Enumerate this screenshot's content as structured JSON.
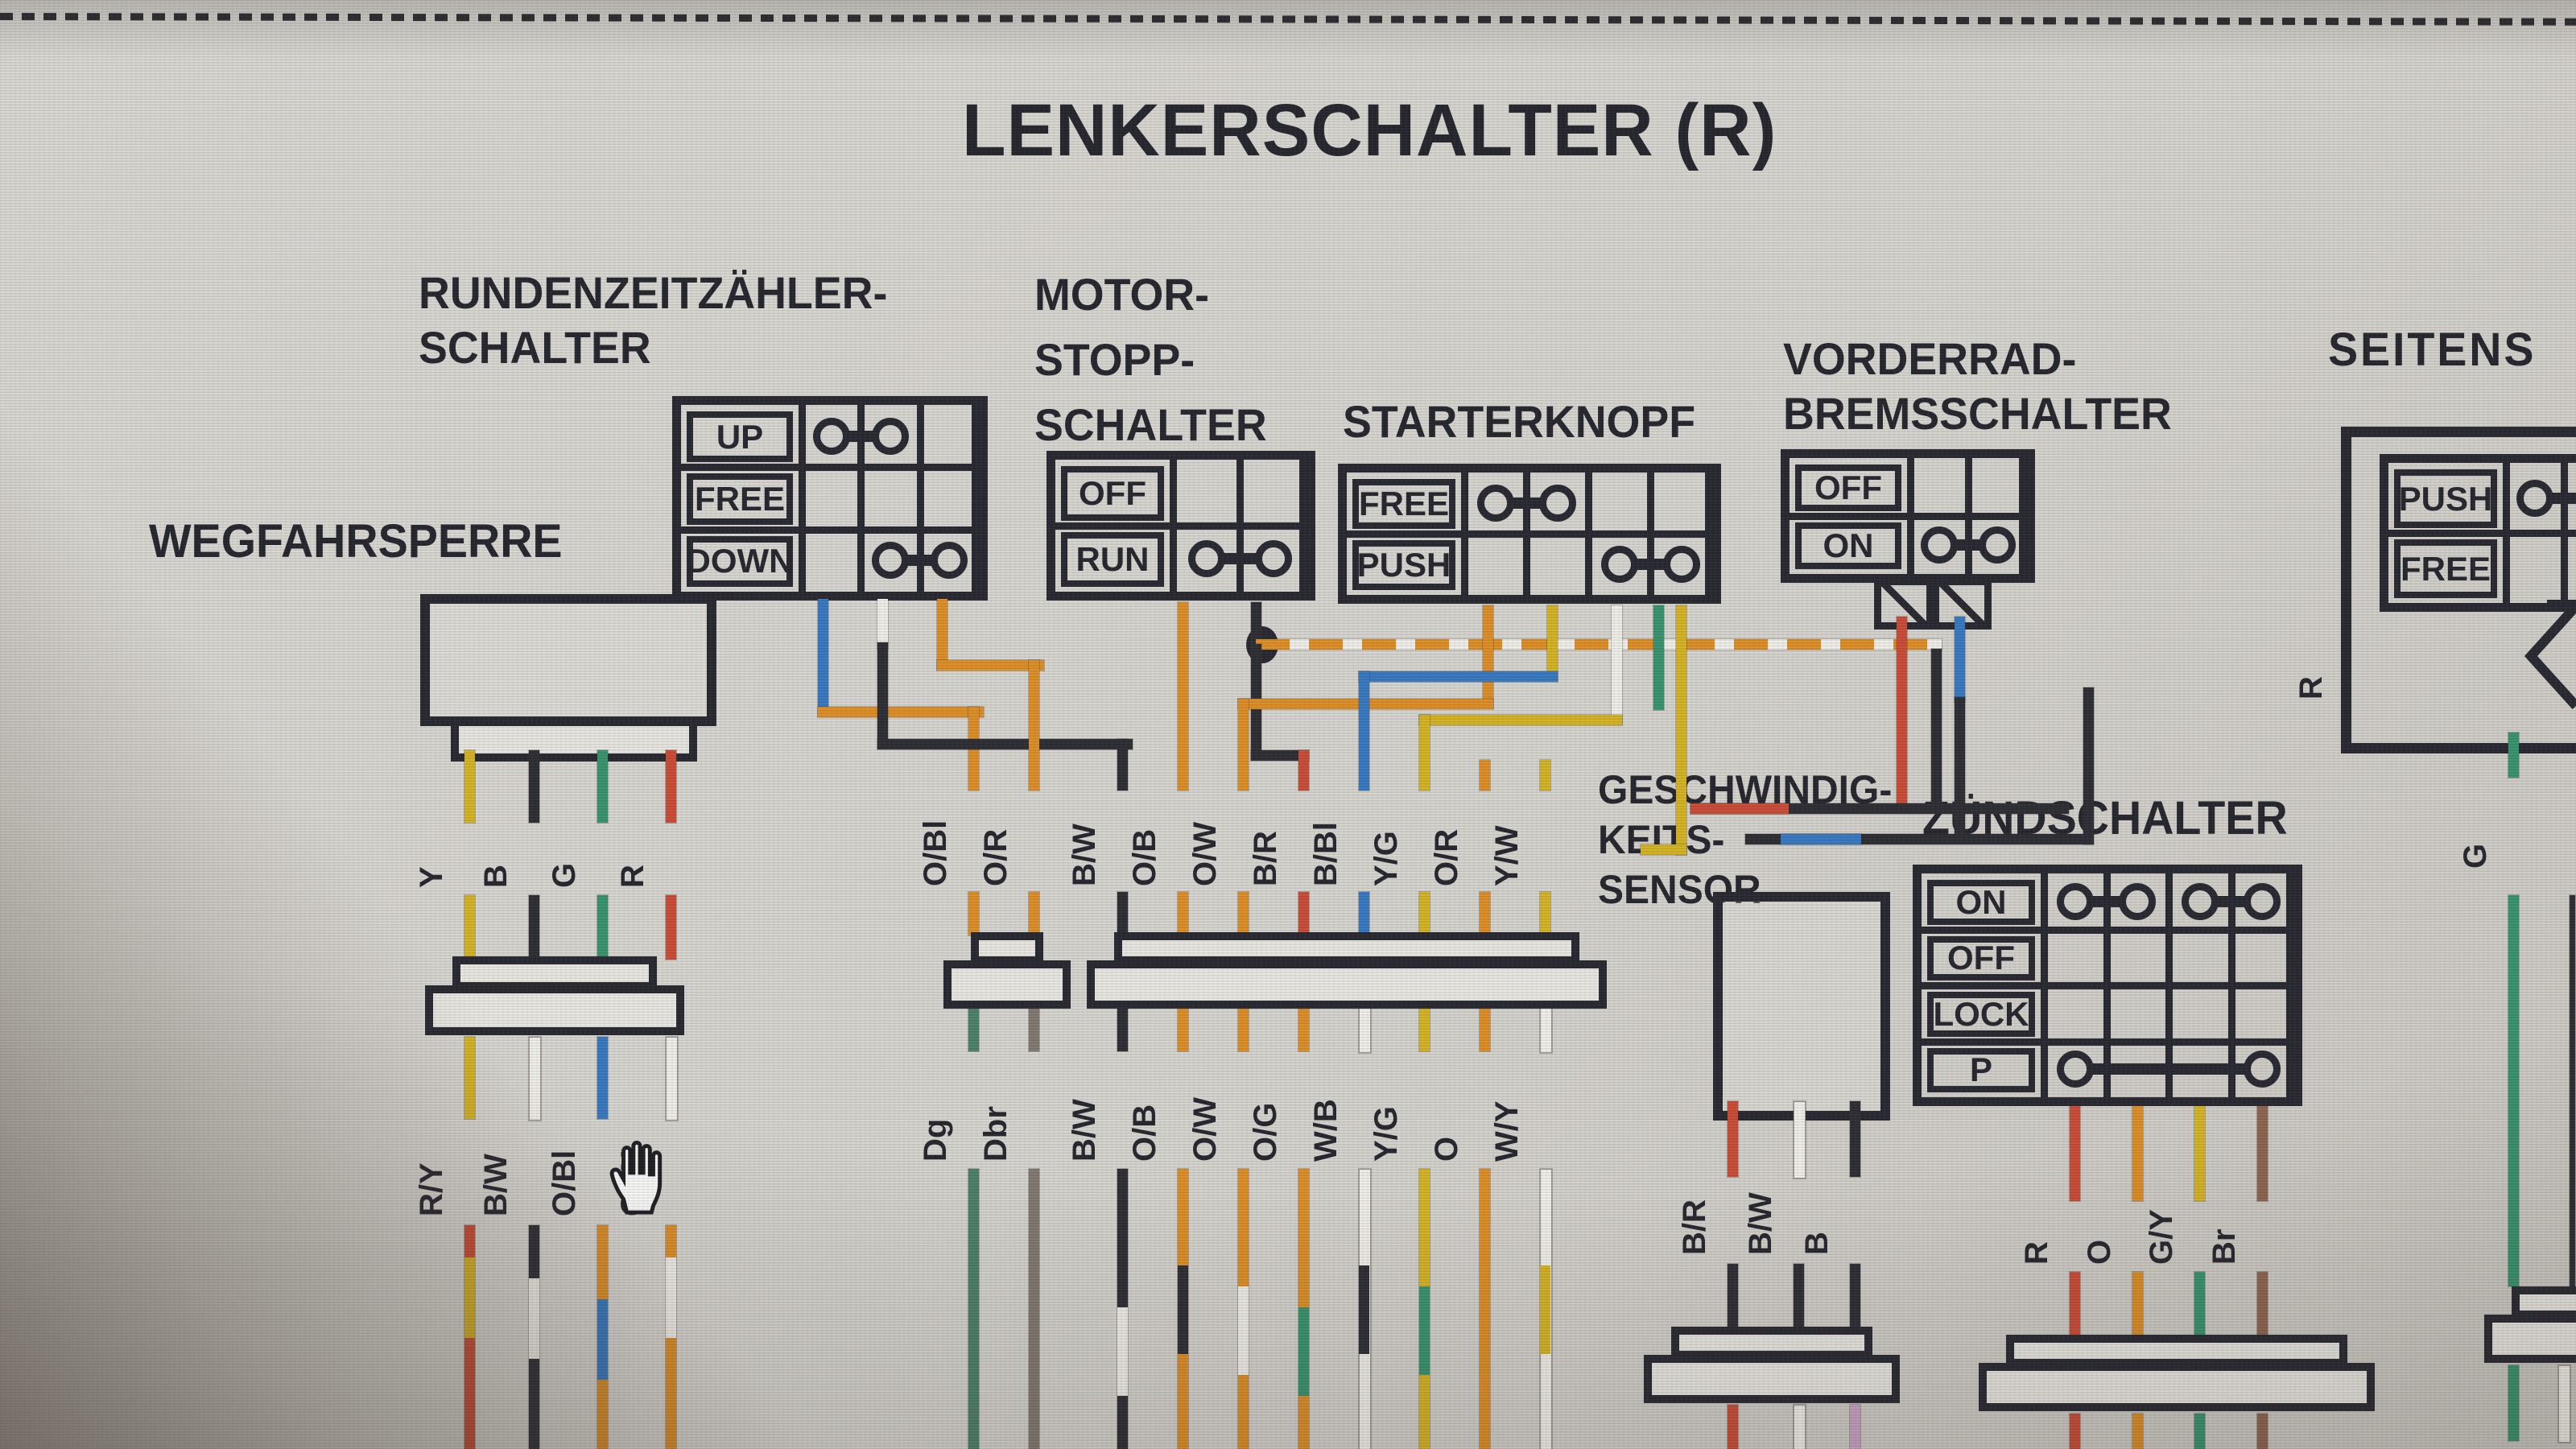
{
  "title": "LENKERSCHALTER (R)",
  "sections": {
    "runden": {
      "line1": "RUNDENZEITZÄHLER-",
      "line2": "SCHALTER"
    },
    "motor": {
      "line1": "MOTOR-",
      "line2": "STOPP-",
      "line3": "SCHALTER"
    },
    "starter": {
      "line1": "STARTERKNOPF"
    },
    "vorder": {
      "line1": "VORDERRAD-",
      "line2": "BREMSSCHALTER"
    },
    "seiten": {
      "line1": "SEITENS"
    },
    "weg": {
      "line1": "WEGFAHRSPERRE"
    },
    "sensor": {
      "line1": "GESCHWINDIG-",
      "line2": "KEITS-",
      "line3": "SENSOR"
    },
    "zuend": {
      "line1": "ZÜNDSCHALTER"
    }
  },
  "switches": {
    "runden": {
      "cols": 3,
      "rows": [
        {
          "label": "UP",
          "bridges": [
            [
              1,
              2
            ]
          ]
        },
        {
          "label": "FREE",
          "bridges": []
        },
        {
          "label": "DOWN",
          "bridges": [
            [
              2,
              3
            ]
          ]
        }
      ]
    },
    "motor": {
      "cols": 2,
      "rows": [
        {
          "label": "OFF",
          "bridges": []
        },
        {
          "label": "RUN",
          "bridges": [
            [
              1,
              2
            ]
          ]
        }
      ]
    },
    "starter": {
      "cols": 4,
      "rows": [
        {
          "label": "FREE",
          "bridges": [
            [
              1,
              2
            ]
          ]
        },
        {
          "label": "PUSH",
          "bridges": [
            [
              3,
              4
            ]
          ]
        }
      ]
    },
    "vorder": {
      "cols": 2,
      "rows": [
        {
          "label": "OFF",
          "bridges": []
        },
        {
          "label": "ON",
          "bridges": [
            [
              1,
              2
            ]
          ]
        }
      ]
    },
    "seiten": {
      "cols": 2,
      "rows": [
        {
          "label": "PUSH",
          "bridges": [
            [
              1,
              2
            ]
          ]
        },
        {
          "label": "FREE",
          "bridges": []
        }
      ]
    },
    "zuend": {
      "cols": 4,
      "rows": [
        {
          "label": "ON",
          "bridges": [
            [
              1,
              2
            ],
            [
              3,
              4
            ]
          ]
        },
        {
          "label": "OFF",
          "bridges": []
        },
        {
          "label": "LOCK",
          "bridges": []
        },
        {
          "label": "P",
          "bridges": [
            [
              1,
              4
            ]
          ]
        }
      ]
    }
  },
  "wires": {
    "weg_top": [
      {
        "label": "Y",
        "base": "yellow"
      },
      {
        "label": "B",
        "base": "black"
      },
      {
        "label": "G",
        "base": "green"
      },
      {
        "label": "R",
        "base": "red"
      }
    ],
    "weg_bottom": [
      {
        "label": "R/Y",
        "base": "red",
        "band": "yellow"
      },
      {
        "label": "B/W",
        "base": "black",
        "band": "white"
      },
      {
        "label": "O/Bl",
        "base": "orange",
        "band": "blue"
      },
      {
        "label": "O/W",
        "base": "orange",
        "band": "white"
      }
    ],
    "mid_top": [
      {
        "label": "O/Bl",
        "base": "orange",
        "band": "blue"
      },
      {
        "label": "O/R",
        "base": "orange",
        "band": "red"
      },
      {
        "label": "B/W",
        "base": "black",
        "band": "white"
      },
      {
        "label": "O/B",
        "base": "orange",
        "band": "black"
      },
      {
        "label": "O/W",
        "base": "orange",
        "band": "white"
      },
      {
        "label": "B/R",
        "base": "red",
        "band": "black"
      },
      {
        "label": "B/Bl",
        "base": "blue",
        "band": "black"
      },
      {
        "label": "Y/G",
        "base": "yellow",
        "band": "green"
      },
      {
        "label": "O/R",
        "base": "orange",
        "band": "red"
      },
      {
        "label": "Y/W",
        "base": "yellow",
        "band": "white"
      }
    ],
    "mid_bottom": [
      {
        "label": "Dg",
        "base": "dgreen"
      },
      {
        "label": "Dbr",
        "base": "graybrown"
      },
      {
        "label": "B/W",
        "base": "black",
        "band": "white"
      },
      {
        "label": "O/B",
        "base": "orange",
        "band": "black"
      },
      {
        "label": "O/W",
        "base": "orange",
        "band": "white"
      },
      {
        "label": "O/G",
        "base": "orange",
        "band": "green"
      },
      {
        "label": "W/B",
        "base": "white",
        "band": "black"
      },
      {
        "label": "Y/G",
        "base": "yellow",
        "band": "green"
      },
      {
        "label": "O",
        "base": "orange"
      },
      {
        "label": "W/Y",
        "base": "white",
        "band": "yellow"
      }
    ],
    "sensor": [
      {
        "label": "B/R",
        "base": "red",
        "band": "black"
      },
      {
        "label": "B/W",
        "base": "white"
      },
      {
        "label": "B",
        "base": "black"
      }
    ],
    "sensor_bottom": [
      {
        "label": "R",
        "base": "red"
      },
      {
        "label": "W",
        "base": "white"
      },
      {
        "label": "",
        "base": "pink"
      }
    ],
    "zuend": [
      {
        "label": "R",
        "base": "red"
      },
      {
        "label": "O",
        "base": "orange"
      },
      {
        "label": "G/Y",
        "base": "yellow",
        "band": "green"
      },
      {
        "label": "Br",
        "base": "brown"
      }
    ],
    "zuend_bottom": [
      {
        "label": "",
        "base": "red"
      },
      {
        "label": "",
        "base": "orange"
      },
      {
        "label": "G",
        "base": "green"
      },
      {
        "label": "",
        "base": "brown"
      }
    ],
    "side": [
      {
        "label": "G",
        "base": "green"
      }
    ],
    "side_bottom": [
      {
        "label": "G",
        "base": "green"
      },
      {
        "label": "W",
        "base": "white"
      }
    ],
    "side_r": [
      {
        "label": "R",
        "base": "red"
      }
    ]
  },
  "palette": {
    "orange": "#dd8a1e",
    "blue": "#2f74c0",
    "red": "#c9452f",
    "yellow": "#d4b11c",
    "green": "#2f9068",
    "dgreen": "#447c64",
    "black": "#25252d",
    "white": "#f1efe9",
    "brown": "#8a5f4a",
    "graybrown": "#7d746b",
    "pink": "#c79fc7",
    "line": "#20202a"
  }
}
